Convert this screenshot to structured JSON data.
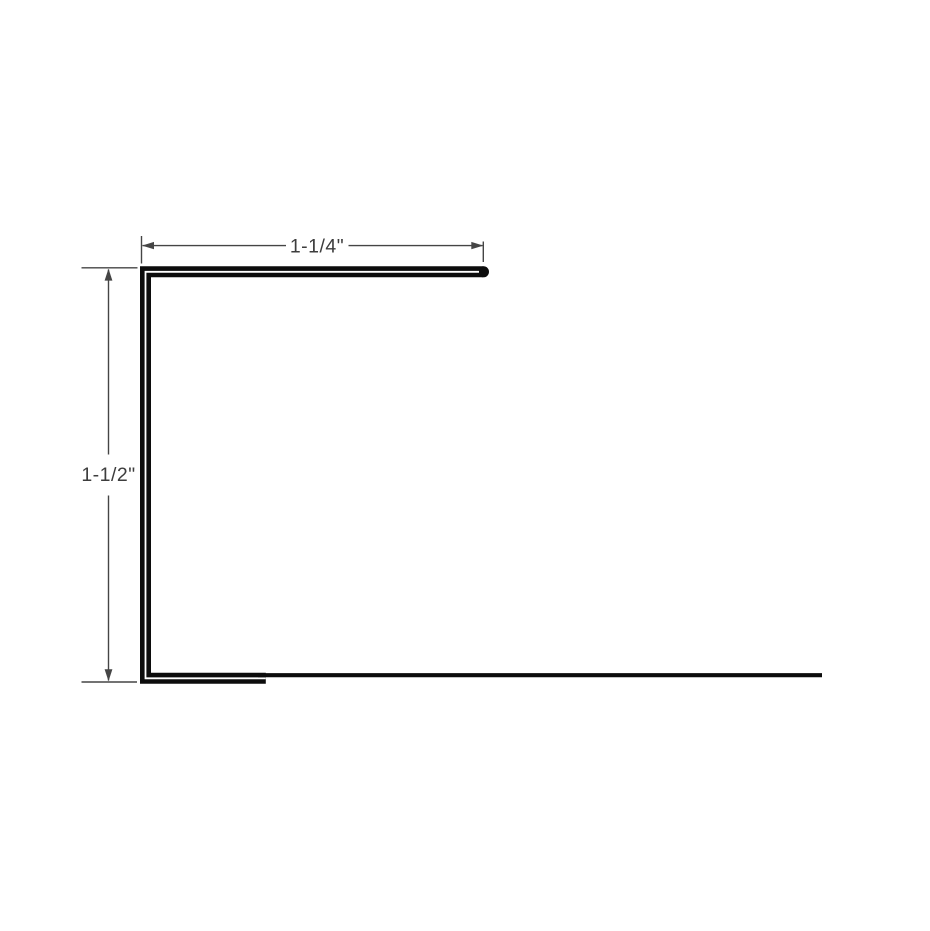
{
  "diagram": {
    "background": "#ffffff",
    "profile_line_color": "#0c0c0c",
    "profile_gap_color": "#ffffff",
    "dimension_line_color": "#454545",
    "label_color": "#3d3d3d",
    "dimensions": {
      "top_width": {
        "label": "1-1/4\""
      },
      "left_height": {
        "label": "1-1/2\""
      }
    }
  }
}
